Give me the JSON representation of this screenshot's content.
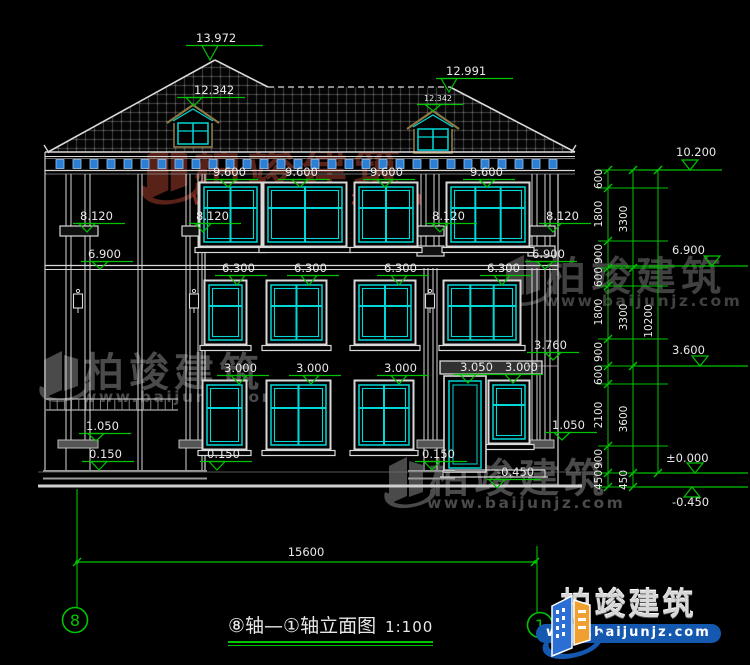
{
  "drawing_title": {
    "text": "⑧轴—①轴立面图",
    "scale": "1:100"
  },
  "logo": {
    "brand": "柏竣建筑",
    "url": "www.baijunjz.com"
  },
  "colors": {
    "bg": "#000000",
    "line": "#d9d9d9",
    "gray": "#8f8f8f",
    "green": "#00c400",
    "cyan": "#00d8d8",
    "corbel_blue": "#2b7fd4",
    "hatch": "#343434",
    "dormer": "#8f7a45",
    "wm_red": "#5e241a",
    "wm_red_url": "#8a2a20",
    "wm_gray": "#4f4f4f",
    "logo_blue": "#1558b0",
    "logo_orange": "#f0a030"
  },
  "elevation_markers": [
    {
      "text": "13.972",
      "tx": 196,
      "ty": 42,
      "lx1": 186,
      "lx2": 263,
      "ax": 210,
      "ay": 60
    },
    {
      "text": "12.991",
      "tx": 446,
      "ty": 75,
      "lx1": 436,
      "lx2": 513,
      "ax": 449,
      "ay": 92
    },
    {
      "text": "12.342",
      "tx": 194,
      "ty": 94,
      "lx1": 177,
      "lx2": 245,
      "ax": 194,
      "ay": 106
    },
    {
      "text": "12.342",
      "tx": 424,
      "ty": 101,
      "lx1": 417,
      "lx2": 463,
      "ax": 433,
      "ay": 111,
      "small": true
    },
    {
      "text": "9.600",
      "tx": 213,
      "ty": 176,
      "lx1": 206,
      "lx2": 258,
      "ax": 228,
      "ay": 187
    },
    {
      "text": "9.600",
      "tx": 285,
      "ty": 176,
      "lx1": 278,
      "lx2": 330,
      "ax": 300,
      "ay": 187
    },
    {
      "text": "9.600",
      "tx": 370,
      "ty": 176,
      "lx1": 363,
      "lx2": 415,
      "ax": 385,
      "ay": 187
    },
    {
      "text": "9.600",
      "tx": 470,
      "ty": 176,
      "lx1": 463,
      "lx2": 515,
      "ax": 487,
      "ay": 187
    },
    {
      "text": "8.120",
      "tx": 80,
      "ty": 220,
      "lx1": 73,
      "lx2": 125,
      "ax": 87,
      "ay": 232
    },
    {
      "text": "8.120",
      "tx": 196,
      "ty": 220,
      "lx1": 189,
      "lx2": 241,
      "ax": 203,
      "ay": 232
    },
    {
      "text": "8.120",
      "tx": 432,
      "ty": 220,
      "lx1": 425,
      "lx2": 477,
      "ax": 440,
      "ay": 232
    },
    {
      "text": "8.120",
      "tx": 546,
      "ty": 220,
      "lx1": 539,
      "lx2": 591,
      "ax": 553,
      "ay": 232
    },
    {
      "text": "6.900",
      "tx": 88,
      "ty": 258,
      "lx1": 81,
      "lx2": 133,
      "ax": 100,
      "ay": 269
    },
    {
      "text": "6.900",
      "tx": 532,
      "ty": 258,
      "lx1": 525,
      "lx2": 577,
      "ax": 545,
      "ay": 269
    },
    {
      "text": "6.300",
      "tx": 222,
      "ty": 272,
      "lx1": 215,
      "lx2": 267,
      "ax": 237,
      "ay": 285
    },
    {
      "text": "6.300",
      "tx": 294,
      "ty": 272,
      "lx1": 287,
      "lx2": 339,
      "ax": 309,
      "ay": 285
    },
    {
      "text": "6.300",
      "tx": 384,
      "ty": 272,
      "lx1": 377,
      "lx2": 429,
      "ax": 399,
      "ay": 285
    },
    {
      "text": "6.300",
      "tx": 487,
      "ty": 272,
      "lx1": 480,
      "lx2": 532,
      "ax": 502,
      "ay": 285
    },
    {
      "text": "3.760",
      "tx": 534,
      "ty": 349,
      "lx1": 527,
      "lx2": 579,
      "ax": 553,
      "ay": 360
    },
    {
      "text": "3.000",
      "tx": 224,
      "ty": 372,
      "lx1": 217,
      "lx2": 269,
      "ax": 239,
      "ay": 384
    },
    {
      "text": "3.000",
      "tx": 296,
      "ty": 372,
      "lx1": 289,
      "lx2": 341,
      "ax": 311,
      "ay": 384
    },
    {
      "text": "3.000",
      "tx": 384,
      "ty": 372,
      "lx1": 377,
      "lx2": 429,
      "ax": 399,
      "ay": 384
    },
    {
      "text": "3.050",
      "tx": 460,
      "ty": 371,
      "lx1": 453,
      "lx2": 498,
      "ax": 468,
      "ay": 383
    },
    {
      "text": "3.000",
      "tx": 505,
      "ty": 371,
      "lx1": 498,
      "lx2": 543,
      "ax": 513,
      "ay": 383
    },
    {
      "text": "1.050",
      "tx": 86,
      "ty": 430,
      "lx1": 79,
      "lx2": 131,
      "ax": 96,
      "ay": 441
    },
    {
      "text": "1.050",
      "tx": 552,
      "ty": 429,
      "lx1": 545,
      "lx2": 597,
      "ax": 562,
      "ay": 440
    },
    {
      "text": "0.150",
      "tx": 89,
      "ty": 458,
      "lx1": 82,
      "lx2": 134,
      "ax": 99,
      "ay": 470
    },
    {
      "text": "0.150",
      "tx": 207,
      "ty": 458,
      "lx1": 200,
      "lx2": 252,
      "ax": 217,
      "ay": 470
    },
    {
      "text": "0.150",
      "tx": 422,
      "ty": 458,
      "lx1": 415,
      "lx2": 467,
      "ax": 432,
      "ay": 470
    },
    {
      "text": "-0.450",
      "tx": 497,
      "ty": 476,
      "lx1": 487,
      "lx2": 541,
      "ax": 497,
      "ay": 488
    }
  ],
  "right_chain": {
    "x_cols": [
      608,
      633,
      658
    ],
    "col1_ticks": [
      170,
      188,
      241,
      268,
      286,
      339,
      366,
      384,
      446,
      473,
      487
    ],
    "col1_dims": [
      {
        "label": "600",
        "y": 179
      },
      {
        "label": "1800",
        "y": 214
      },
      {
        "label": "900",
        "y": 254
      },
      {
        "label": "600",
        "y": 277
      },
      {
        "label": "1800",
        "y": 312
      },
      {
        "label": "900",
        "y": 352
      },
      {
        "label": "600",
        "y": 375
      },
      {
        "label": "2100",
        "y": 415
      },
      {
        "label": "900",
        "y": 459
      },
      {
        "label": "450",
        "y": 480
      }
    ],
    "col2_ticks": [
      170,
      268,
      366,
      473,
      487
    ],
    "col2_dims": [
      {
        "label": "3300",
        "y": 219
      },
      {
        "label": "3300",
        "y": 317
      },
      {
        "label": "3600",
        "y": 419
      },
      {
        "label": "450",
        "y": 480
      }
    ],
    "col3_ticks": [
      170,
      473
    ],
    "col3_dims": [
      {
        "label": "10200",
        "y": 321
      }
    ],
    "markers": [
      {
        "label": "10.200",
        "tx": 676,
        "ty": 156,
        "lx1": 638,
        "lx2": 722,
        "ax": 690,
        "ly": 170
      },
      {
        "label": "6.900",
        "tx": 672,
        "ty": 254,
        "lx1": 608,
        "lx2": 748,
        "ax": 712,
        "ly": 266
      },
      {
        "label": "3.600",
        "tx": 672,
        "ty": 354,
        "lx1": 638,
        "lx2": 748,
        "ax": 700,
        "ly": 366
      },
      {
        "label": "±0.000",
        "tx": 666,
        "ty": 462,
        "lx1": 638,
        "lx2": 748,
        "ax": 695,
        "ly": 473
      },
      {
        "label": "-0.450",
        "tx": 672,
        "ty": 506,
        "lx1": 638,
        "lx2": 748,
        "ax": 692,
        "ly": 487,
        "up": true
      }
    ]
  },
  "bottom_dimension": {
    "label": "15600",
    "y": 562,
    "x1": 77,
    "x2": 535
  },
  "axis_bubbles": [
    {
      "label": "8",
      "x": 75,
      "y": 620,
      "ext_top": 489,
      "ext_x": 77
    },
    {
      "label": "1",
      "x": 540,
      "y": 625,
      "ext_top": 546,
      "ext_x": 537
    }
  ],
  "windows": {
    "floor3": [
      {
        "x": 203,
        "y": 186,
        "w": 55,
        "h": 57,
        "cols": 2
      },
      {
        "x": 267,
        "y": 186,
        "w": 76,
        "h": 57,
        "cols": 2
      },
      {
        "x": 358,
        "y": 186,
        "w": 56,
        "h": 57,
        "cols": 2
      },
      {
        "x": 450,
        "y": 186,
        "w": 76,
        "h": 57,
        "cols": 3
      }
    ],
    "floor2": [
      {
        "x": 208,
        "y": 284,
        "w": 35,
        "h": 57,
        "cols": 1
      },
      {
        "x": 270,
        "y": 284,
        "w": 53,
        "h": 57,
        "cols": 2
      },
      {
        "x": 358,
        "y": 284,
        "w": 54,
        "h": 57,
        "cols": 2
      },
      {
        "x": 447,
        "y": 284,
        "w": 70,
        "h": 57,
        "cols": 3
      }
    ],
    "floor1": [
      {
        "x": 206,
        "y": 384,
        "w": 37,
        "h": 62,
        "cols": 1
      },
      {
        "x": 270,
        "y": 384,
        "w": 57,
        "h": 62,
        "cols": 2
      },
      {
        "x": 358,
        "y": 384,
        "w": 52,
        "h": 62,
        "cols": 2
      },
      {
        "x": 492,
        "y": 384,
        "w": 34,
        "h": 56,
        "cols": 1
      }
    ]
  },
  "door": {
    "x": 444,
    "y": 376,
    "w": 42,
    "h": 96
  },
  "lintel": {
    "x": 440,
    "y": 361,
    "w": 102,
    "h": 13
  },
  "dormers": [
    {
      "px": 193,
      "py": 106
    },
    {
      "px": 433,
      "py": 112
    }
  ],
  "roof": {
    "peak": [
      215,
      60
    ],
    "eave_l": [
      48,
      152
    ],
    "eave_r": [
      575,
      152
    ],
    "ridge": [
      [
        268,
        87
      ],
      [
        450,
        87
      ]
    ]
  },
  "watermarks": [
    {
      "brand": "柏竣建筑",
      "url": "www.baijunjz.com",
      "x": 140,
      "y": 136,
      "s": 1.18,
      "color": "#5e241a",
      "url_color": "#8a2a20"
    },
    {
      "brand": "柏竣建筑",
      "url": "www.baijunjz.com",
      "x": 500,
      "y": 248,
      "s": 1.0,
      "color": "#454545",
      "url_color": "#454545"
    },
    {
      "brand": "柏竣建筑",
      "url": "www.baijunjz.com",
      "x": 38,
      "y": 344,
      "s": 1.0,
      "color": "#4f4f4f",
      "url_color": "#4f4f4f"
    },
    {
      "brand": "柏竣建筑",
      "url": "www.baijunjz.com",
      "x": 383,
      "y": 450,
      "s": 1.0,
      "color": "#4f4f4f",
      "url_color": "#4f4f4f"
    }
  ]
}
